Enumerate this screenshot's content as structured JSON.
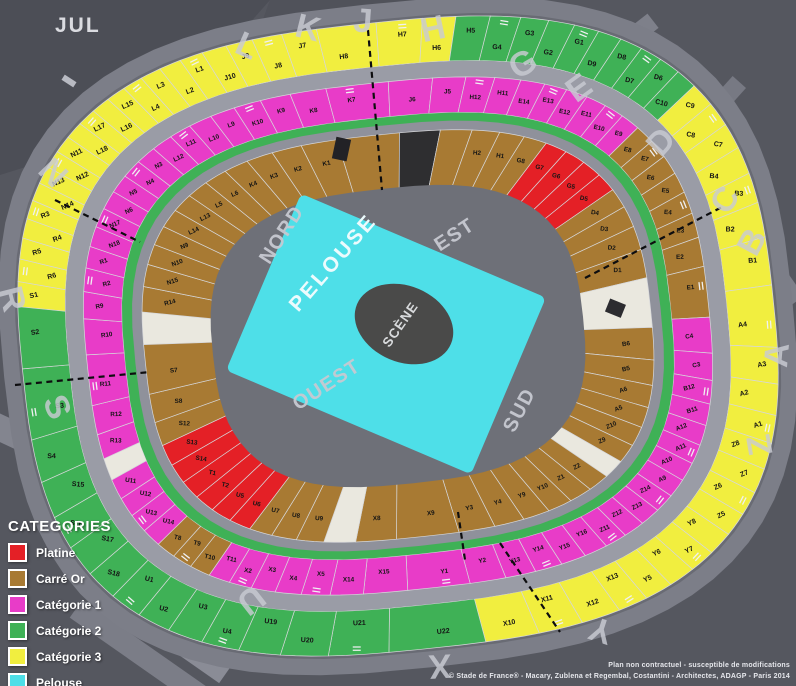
{
  "month_label": "JUL",
  "field": {
    "pelouse": "PELOUSE",
    "scene": "SCÈNE"
  },
  "stands": {
    "nord": "NORD",
    "est": "EST",
    "sud": "SUD",
    "ouest": "OUEST"
  },
  "colors": {
    "platine": "#e42026",
    "carre_or": "#a87a33",
    "cat1": "#e83cc8",
    "cat2": "#3fb156",
    "cat3": "#f1ee3f",
    "pelouse": "#4edfe8",
    "white_section": "#eae8df",
    "tunnel": "#2e2e30"
  },
  "legend": {
    "title": "CATEGORIES",
    "items": [
      {
        "label": "Platine",
        "key": "platine",
        "color": "#e42026"
      },
      {
        "label": "Carré Or",
        "key": "carre-or",
        "color": "#a87a33"
      },
      {
        "label": "Catégorie 1",
        "key": "cat-1",
        "color": "#e83cc8"
      },
      {
        "label": "Catégorie 2",
        "key": "cat-2",
        "color": "#3fb156"
      },
      {
        "label": "Catégorie 3",
        "key": "cat-3",
        "color": "#f1ee3f"
      },
      {
        "label": "Pelouse",
        "key": "pelouse",
        "color": "#4edfe8"
      }
    ]
  },
  "gate_letters": [
    {
      "t": "L",
      "x": 247,
      "y": 46,
      "r": 24
    },
    {
      "t": "K",
      "x": 308,
      "y": 28,
      "r": 14
    },
    {
      "t": "J",
      "x": 363,
      "y": 21,
      "r": 4
    },
    {
      "t": "H",
      "x": 433,
      "y": 29,
      "r": -12
    },
    {
      "t": "G",
      "x": 523,
      "y": 64,
      "r": -30
    },
    {
      "t": "E",
      "x": 579,
      "y": 88,
      "r": -36
    },
    {
      "t": "D",
      "x": 661,
      "y": 142,
      "r": -48
    },
    {
      "t": "C",
      "x": 725,
      "y": 200,
      "r": -58
    },
    {
      "t": "B",
      "x": 752,
      "y": 242,
      "r": -62
    },
    {
      "t": "A",
      "x": 777,
      "y": 355,
      "r": -85
    },
    {
      "t": "Z",
      "x": 760,
      "y": 445,
      "r": -100
    },
    {
      "t": "Y",
      "x": 601,
      "y": 630,
      "r": -162
    },
    {
      "t": "X",
      "x": 440,
      "y": 666,
      "r": 177
    },
    {
      "t": "U",
      "x": 251,
      "y": 600,
      "r": 142
    },
    {
      "t": "S",
      "x": 57,
      "y": 407,
      "r": 68
    },
    {
      "t": "R",
      "x": 12,
      "y": 299,
      "r": 76
    },
    {
      "t": "N",
      "x": 53,
      "y": 173,
      "r": 46
    }
  ],
  "rings": [
    {
      "name": "outer",
      "arcs": [
        {
          "from": 277,
          "to": 368,
          "sections": [
            "S1|c3",
            "R6|c3",
            "R5|c3",
            "R4|c3",
            "R3|c3",
            "N14|c3",
            "N13|c3",
            "N12|c3",
            "N11|c3",
            "L18|c3",
            "L17|c3",
            "L16|c3",
            "L15|c3",
            "L4|c3",
            "L3|c3",
            "L2|c3",
            "L1|c3",
            "J10|c3",
            "J9|c3",
            "J8|c3",
            "J7|c3",
            "H8|c3",
            "H7|c3",
            "H6|c3"
          ]
        },
        {
          "from": 368,
          "to": 413,
          "sections": [
            "H5|c2",
            "G4|c2",
            "G3|c2",
            "G2|c2",
            "G1|c2",
            "D9|c2",
            "D8|c2",
            "D7|c2",
            "D6|c2",
            "C10|c2"
          ]
        },
        {
          "from": 413,
          "to": 517,
          "sections": [
            "C9|c3",
            "C8|c3",
            "C7|c3",
            "B4|c3",
            "B3|c3",
            "B2|c3",
            "B1|c3",
            "A4|c3",
            "A3|c3",
            "A2|c3",
            "A1|c3",
            "Z8|c3",
            "Z7|c3",
            "Z6|c3",
            "Z5|c3",
            "Y8|c3",
            "Y7|c3",
            "Y6|c3",
            "Y5|c3",
            "X13|c3"
          ]
        },
        {
          "from": 517,
          "to": 536,
          "sections": [
            "X12|c3",
            "X11|c3",
            "X10|c3"
          ]
        },
        {
          "from": 536,
          "to": 637,
          "sections": [
            "U22|c2",
            "U21|c2",
            "U20|c2",
            "U19|c2",
            "U4|c2",
            "U3|c2",
            "U2|c2",
            "U1|c2",
            "S18|c2",
            "S17|c2",
            "S16|c2",
            "S15|c2",
            "S4|c2",
            "S3|c2",
            "S2|c2"
          ]
        }
      ]
    },
    {
      "name": "middle",
      "arcs": [
        {
          "from": 246,
          "to": 606,
          "sections": [
            "U11|c1",
            "|w",
            "R13|c1",
            "R12|c1",
            "R11|c1",
            "R10|c1",
            "R9|c1",
            "R2|c1",
            "R1|c1",
            "N18|c1",
            "N17|c1",
            "N6|c1",
            "N5|c1",
            "N4|c1",
            "N3|c1",
            "L12|c1",
            "L11|c1",
            "L10|c1",
            "L9|c1",
            "K10|c1",
            "K9|c1",
            "K8|c1",
            "K7|c1",
            "J6|c1",
            "J5|c1",
            "H12|c1",
            "H11|c1",
            "E14|c1",
            "E13|c1",
            "E12|c1",
            "E11|c1",
            "E10|c1",
            "E9|c1",
            "E8|or",
            "E7|or",
            "E6|or",
            "E5|or",
            "E4|or",
            "E3|or",
            "E2|or",
            "E1|or",
            "C4|c1",
            "C3|c1",
            "B12|c1",
            "B11|c1",
            "A12|c1",
            "A11|c1",
            "A10|c1",
            "A9|c1",
            "Z14|c1",
            "Z13|c1",
            "Z12|c1",
            "Z11|c1",
            "Y16|c1",
            "Y15|c1",
            "Y14|c1",
            "Y13|c1",
            "Y2|c1",
            "Y1|c1",
            "X15|c1",
            "X14|c1",
            "X5|c1",
            "X4|c1",
            "X3|c1",
            "X2|c1",
            "T11|c1",
            "T10|or",
            "T9|or",
            "T8|or",
            "U14|c1",
            "U13|c1",
            "U12|c1"
          ]
        }
      ]
    },
    {
      "name": "inner",
      "arcs": [
        {
          "from": 272,
          "to": 632,
          "sections": [
            "|w",
            "R14|or",
            "N15|or",
            "N10|or",
            "N9|or",
            "L14|or",
            "L13|or",
            "L5|or",
            "L6|or",
            "K4|or",
            "K3|or",
            "K2|or",
            "K1|or",
            "|or",
            "|dk",
            "|or",
            "H2|or",
            "H1|or",
            "G8|or",
            "G7|p",
            "G6|p",
            "G5|p",
            "D5|p",
            "D4|or",
            "D3|or",
            "D2|or",
            "D1|or",
            "|w",
            "B6|or",
            "B5|or",
            "A6|or",
            "A5|or",
            "Z10|or",
            "Z9|or",
            "|w",
            "Z2|or",
            "Z1|or",
            "Y10|or",
            "Y9|or",
            "Y4|or",
            "Y3|or",
            "X9|or",
            "X8|or",
            "|w",
            "U9|or",
            "U8|or",
            "U7|or",
            "U6|p",
            "U5|p",
            "T2|p",
            "T1|p",
            "S14|p",
            "S13|p",
            "S12|or",
            "S8|or",
            "S7|or"
          ]
        }
      ]
    }
  ],
  "footer": {
    "line1": "Plan non contractuel - susceptible de modifications",
    "line2": "© Stade de France® - Macary, Zublena et Regembal, Costantini - Architectes, ADAGP - Paris 2014"
  }
}
